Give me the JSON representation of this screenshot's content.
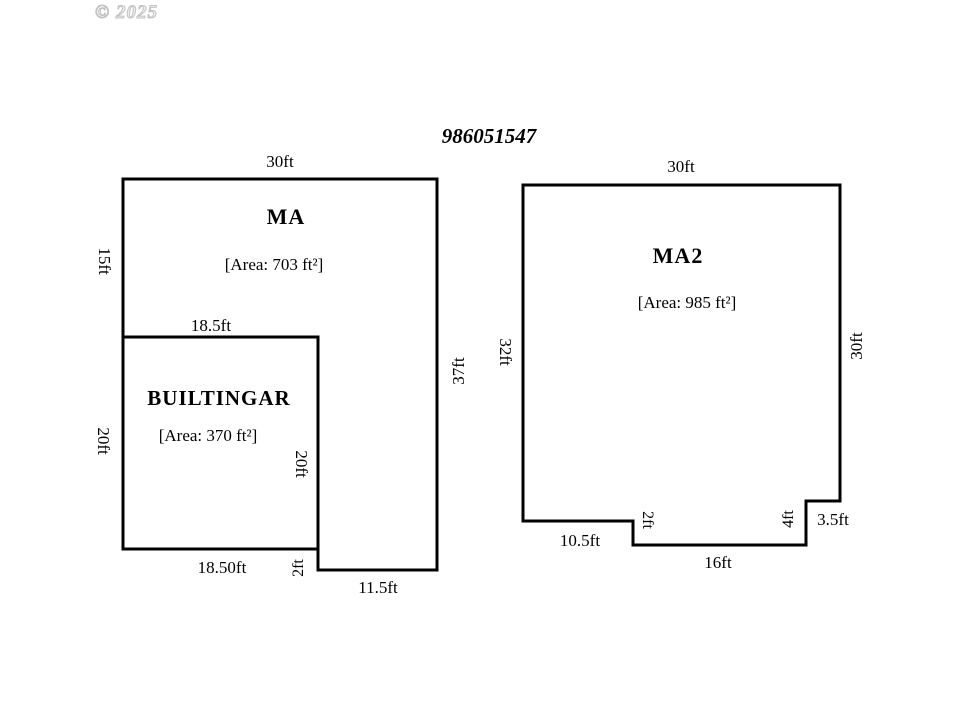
{
  "watermark": "© 2025",
  "plan": {
    "title": "986051547",
    "left_building": {
      "name": "MA",
      "area_label": "[Area: 703 ft²]",
      "dim_top": "30ft",
      "dim_left_upper": "15ft",
      "dim_left_lower": "20ft",
      "dim_right": "37ft",
      "dim_step": "2ft",
      "dim_bottom_right": "11.5ft",
      "garage": {
        "name": "BUILTINGAR",
        "area_label": "[Area: 370 ft²]",
        "dim_top": "18.5ft",
        "dim_right": "20ft",
        "dim_bottom": "18.50ft"
      }
    },
    "right_building": {
      "name": "MA2",
      "area_label": "[Area: 985 ft²]",
      "dim_top": "30ft",
      "dim_left": "32ft",
      "dim_right": "30ft",
      "dim_bottom_left": "10.5ft",
      "dim_step_left": "2ft",
      "dim_bottom_mid": "16ft",
      "dim_step_right": "4ft",
      "dim_notch": "3.5ft"
    },
    "colors": {
      "line": "#000000",
      "text": "#000000",
      "background": "#ffffff",
      "watermark": "#c2c2c2"
    }
  }
}
